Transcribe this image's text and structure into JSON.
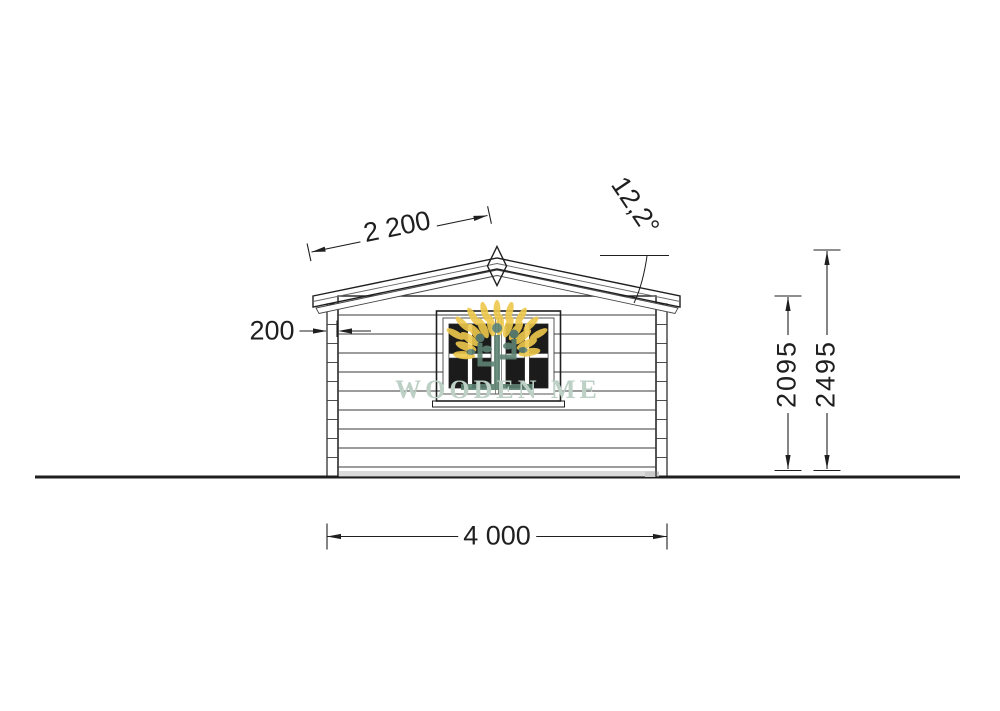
{
  "title": "Wooden cabin front elevation drawing",
  "watermark": {
    "brand": "WOODEN ME"
  },
  "dimensions": {
    "roof_slope_mm": "2 200",
    "roof_angle_deg": "12,2°",
    "wall_log_thickness_mm": "200",
    "wall_height_mm": "2095",
    "ridge_height_mm": "2495",
    "overall_width_mm": "4 000"
  },
  "colors": {
    "line": "#1f1f1f",
    "fascia_fill": "#e6e6e6",
    "glass": "#1b1b1b",
    "plinth": "#dadada",
    "logo_yellow": "#eec84b",
    "logo_green": "#5d8272",
    "watermark_text": "#bdd0c5"
  }
}
